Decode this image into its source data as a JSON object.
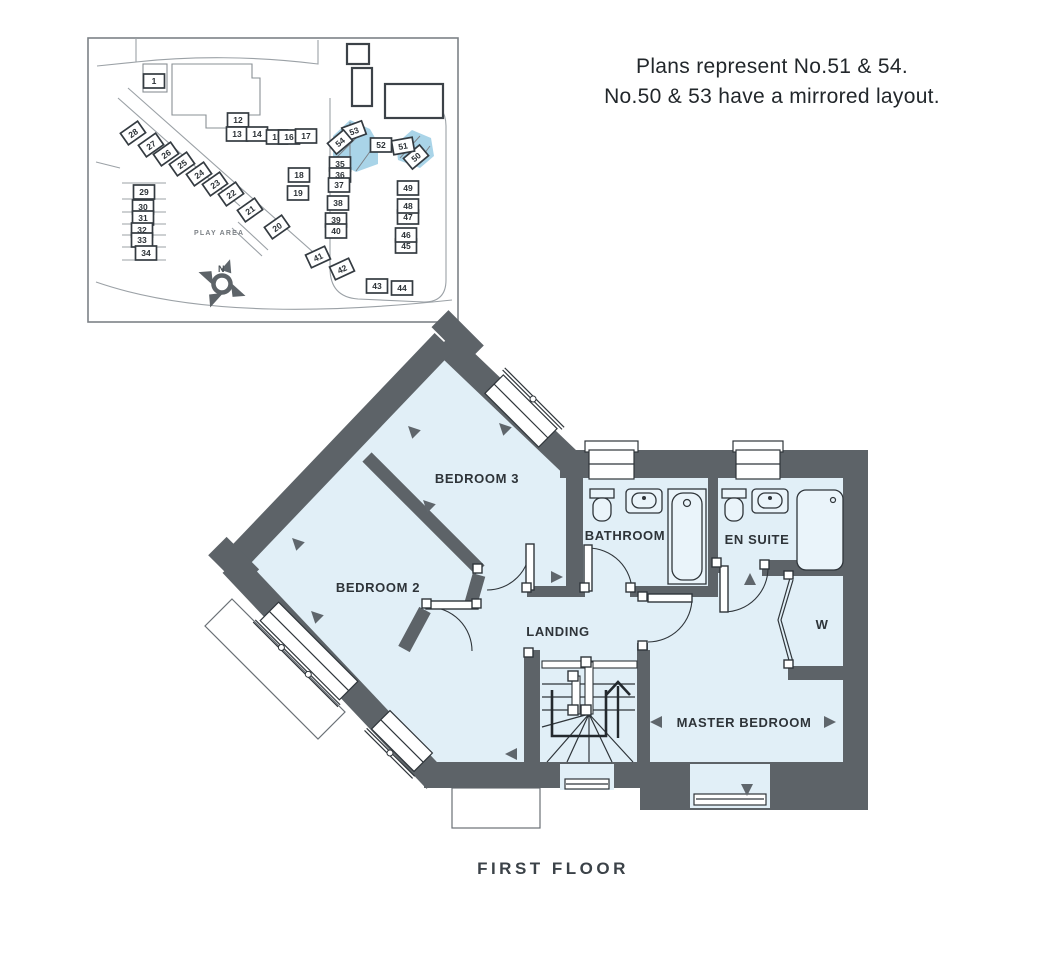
{
  "note": {
    "line1": "Plans represent No.51 & 54.",
    "line2": "No.50 & 53 have a mirrored layout."
  },
  "floor_label": "FIRST FLOOR",
  "rooms": {
    "bedroom3": "BEDROOM 3",
    "bedroom2": "BEDROOM 2",
    "bathroom": "BATHROOM",
    "ensuite": "EN SUITE",
    "landing": "LANDING",
    "wardrobe": "W",
    "master": "MASTER BEDROOM"
  },
  "site_plan": {
    "play_area": "PLAY AREA",
    "north": "N",
    "highlighted_plots": [
      "50",
      "51",
      "53",
      "54"
    ],
    "plots": [
      {
        "n": "1",
        "x": 154,
        "y": 81,
        "r": 0
      },
      {
        "n": "12",
        "x": 238,
        "y": 120,
        "r": 0
      },
      {
        "n": "13",
        "x": 237,
        "y": 134,
        "r": 0
      },
      {
        "n": "14",
        "x": 257,
        "y": 134,
        "r": 0
      },
      {
        "n": "15",
        "x": 277,
        "y": 137,
        "r": 0
      },
      {
        "n": "16",
        "x": 289,
        "y": 137,
        "r": 0
      },
      {
        "n": "17",
        "x": 306,
        "y": 136,
        "r": 0
      },
      {
        "n": "18",
        "x": 299,
        "y": 175,
        "r": 0
      },
      {
        "n": "19",
        "x": 298,
        "y": 193,
        "r": 0
      },
      {
        "n": "20",
        "x": 277,
        "y": 227,
        "r": -35
      },
      {
        "n": "21",
        "x": 250,
        "y": 210,
        "r": -35
      },
      {
        "n": "22",
        "x": 231,
        "y": 194,
        "r": -35
      },
      {
        "n": "23",
        "x": 215,
        "y": 184,
        "r": -35
      },
      {
        "n": "24",
        "x": 199,
        "y": 174,
        "r": -35
      },
      {
        "n": "25",
        "x": 182,
        "y": 164,
        "r": -35
      },
      {
        "n": "26",
        "x": 166,
        "y": 154,
        "r": -35
      },
      {
        "n": "27",
        "x": 151,
        "y": 145,
        "r": -35
      },
      {
        "n": "28",
        "x": 133,
        "y": 133,
        "r": -35
      },
      {
        "n": "29",
        "x": 144,
        "y": 192,
        "r": 0
      },
      {
        "n": "30",
        "x": 143,
        "y": 207,
        "r": 0
      },
      {
        "n": "31",
        "x": 143,
        "y": 218,
        "r": 0
      },
      {
        "n": "32",
        "x": 142,
        "y": 230,
        "r": 0
      },
      {
        "n": "33",
        "x": 142,
        "y": 240,
        "r": 0
      },
      {
        "n": "34",
        "x": 146,
        "y": 253,
        "r": 0
      },
      {
        "n": "35",
        "x": 340,
        "y": 164,
        "r": 0
      },
      {
        "n": "36",
        "x": 340,
        "y": 175,
        "r": 0
      },
      {
        "n": "37",
        "x": 339,
        "y": 185,
        "r": 0
      },
      {
        "n": "38",
        "x": 338,
        "y": 203,
        "r": 0
      },
      {
        "n": "39",
        "x": 336,
        "y": 220,
        "r": 0
      },
      {
        "n": "40",
        "x": 336,
        "y": 231,
        "r": 0
      },
      {
        "n": "41",
        "x": 318,
        "y": 257,
        "r": -25
      },
      {
        "n": "42",
        "x": 342,
        "y": 269,
        "r": -25
      },
      {
        "n": "43",
        "x": 377,
        "y": 286,
        "r": 0
      },
      {
        "n": "44",
        "x": 402,
        "y": 288,
        "r": 0
      },
      {
        "n": "45",
        "x": 406,
        "y": 246,
        "r": 0
      },
      {
        "n": "46",
        "x": 406,
        "y": 235,
        "r": 0
      },
      {
        "n": "47",
        "x": 408,
        "y": 217,
        "r": 0
      },
      {
        "n": "48",
        "x": 408,
        "y": 206,
        "r": 0
      },
      {
        "n": "49",
        "x": 408,
        "y": 188,
        "r": 0
      },
      {
        "n": "50",
        "x": 416,
        "y": 157,
        "r": -40
      },
      {
        "n": "51",
        "x": 403,
        "y": 146,
        "r": -10
      },
      {
        "n": "52",
        "x": 381,
        "y": 145,
        "r": 0
      },
      {
        "n": "53",
        "x": 354,
        "y": 131,
        "r": -20
      },
      {
        "n": "54",
        "x": 340,
        "y": 142,
        "r": -40
      }
    ]
  },
  "colors": {
    "wall": "#5d6368",
    "room_fill": "#e1eff7",
    "site_highlight": "#a9d4e8",
    "line": "#2f353a"
  }
}
